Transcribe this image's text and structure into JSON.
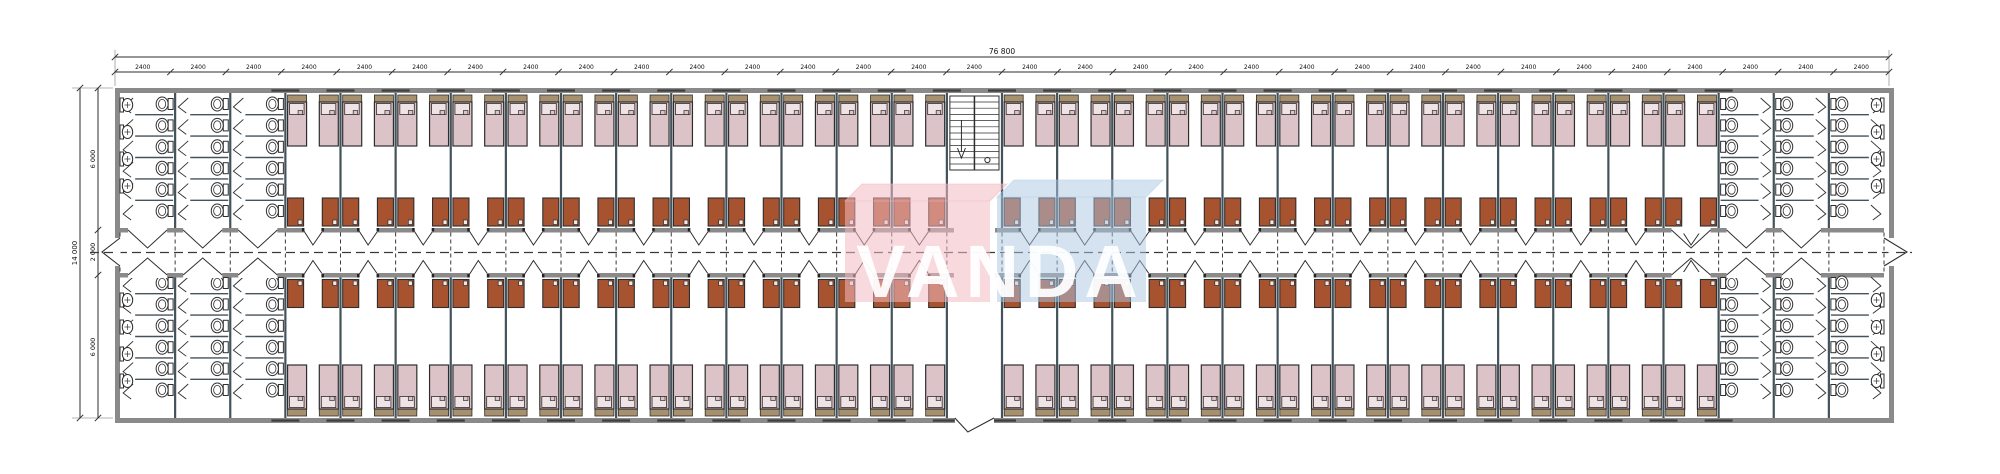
{
  "drawing": {
    "type": "dormitory-floor-plan",
    "watermark": {
      "text": "VANDA",
      "pink_box_color": "#f2b9c1",
      "blue_box_color": "#abc8e4",
      "letter_color": "#ffffff"
    },
    "dimensions": {
      "total_width_label": "76 800",
      "bay_width_label": "2400",
      "bay_count": 32,
      "total_depth_label": "14 000",
      "depth_segment_labels": [
        "6 000",
        "2 000",
        "6 000"
      ]
    },
    "layout_counts": {
      "room_bays_top": 25,
      "room_bays_bottom": 25,
      "beds_per_room": 2,
      "cabinets_per_room": 2,
      "sanitary_bays_per_end": 3,
      "toilet_columns_per_block": 3,
      "toilets_per_column": 6,
      "basins_per_end_wall_top": 4,
      "basins_per_end_wall_bottom": 4,
      "stair_bay_index": 16,
      "entrance_bay_index": 16
    },
    "colors": {
      "wall": "#8a8a8a",
      "wall_dark": "#3f3f3f",
      "partition": "#44525b",
      "line": "#2e2e2e",
      "dash": "#3a3a3a",
      "bed_fill": "#dcc3c8",
      "pillow_fill": "#efe3e5",
      "headboard_fill": "#a6906d",
      "cabinet_fill": "#a85330",
      "fixture_stroke": "#2e2e2e",
      "dim_text": "#111111"
    }
  }
}
